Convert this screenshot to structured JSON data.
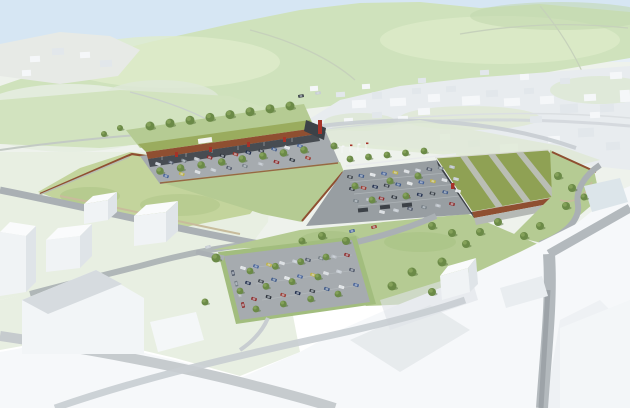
{
  "colors": {
    "sky_top": "#d6e6f3",
    "sky_mid": "#e7eff6",
    "base_pale": "#eef2ec",
    "hill_green": "#cfe2bc",
    "hill_light": "#deecca",
    "hill_dark": "#c1d7ad",
    "mint": "#e8efe2",
    "town_base": "#e8ecef",
    "town_block": "#f5f7f9",
    "town_block_shade": "#e2e7eb",
    "town_shadow": "#cfd5da",
    "meadow": "#c3d49c",
    "slope_green": "#b5cb93",
    "slope_dark": "#a2bd7e",
    "roof_green": "#8fa154",
    "roof_light": "#9aac5e",
    "roof_stripe": "#babeb4",
    "corten": "#8f4f31",
    "wall_grey": "#b7bcb3",
    "asphalt": "#a6abaf",
    "asphalt_dark": "#989ea2",
    "road_grey": "#aab0b4",
    "road_light": "#c8cdd1",
    "path_tan": "#c8bc9c",
    "storefront": "#474c52",
    "dark_unit": "#3c4147",
    "accent_red": "#a63228",
    "fence": "#e9ebec",
    "white_roof": "#fafbfc",
    "white_front": "#f0f3f5",
    "white_side": "#dfe4e8",
    "fg_white": "#f6f8fa",
    "fg_shadow": "#e3e7ea",
    "glass": "#dce5ea",
    "tree": "#6b8a47",
    "tree_light": "#84a159",
    "tree_dark": "#4e6a33"
  },
  "car_palette": [
    "#c7ccd2",
    "#2f353d",
    "#e8eaeb",
    "#51596a",
    "#9d3a31",
    "#47639a",
    "#778087",
    "#23304e",
    "#c0b344",
    "#b9bec4",
    "#3b4148",
    "#dfe1e3",
    "#8f2c2c",
    "#405a88"
  ],
  "car_rows": [
    {
      "x1": 158,
      "y1": 164,
      "x2": 300,
      "y2": 146,
      "n": 12,
      "rot": 20
    },
    {
      "x1": 166,
      "y1": 176,
      "x2": 308,
      "y2": 158,
      "n": 10,
      "rot": 20
    },
    {
      "x1": 350,
      "y1": 177,
      "x2": 452,
      "y2": 167,
      "n": 10,
      "rot": 15
    },
    {
      "x1": 352,
      "y1": 189,
      "x2": 456,
      "y2": 179,
      "n": 10,
      "rot": 15
    },
    {
      "x1": 356,
      "y1": 201,
      "x2": 458,
      "y2": 191,
      "n": 9,
      "rot": 15
    },
    {
      "x1": 382,
      "y1": 212,
      "x2": 452,
      "y2": 204,
      "n": 6,
      "rot": 15
    },
    {
      "x1": 243,
      "y1": 268,
      "x2": 347,
      "y2": 255,
      "n": 9,
      "rot": 18
    },
    {
      "x1": 248,
      "y1": 283,
      "x2": 352,
      "y2": 270,
      "n": 9,
      "rot": 18
    },
    {
      "x1": 254,
      "y1": 299,
      "x2": 356,
      "y2": 285,
      "n": 8,
      "rot": 18
    },
    {
      "x1": 233,
      "y1": 273,
      "x2": 243,
      "y2": 305,
      "n": 4,
      "rot": 75
    }
  ],
  "cars_single": [
    {
      "x": 352,
      "y": 231,
      "rot": -14,
      "color": "#47639a"
    },
    {
      "x": 208,
      "y": 247,
      "rot": -16,
      "color": "#c7ccd2"
    },
    {
      "x": 374,
      "y": 227,
      "rot": -14,
      "color": "#9d3a31"
    },
    {
      "x": 301,
      "y": 96,
      "rot": -8,
      "color": "#2f353d"
    },
    {
      "x": 318,
      "y": 93,
      "rot": -8,
      "color": "#c7ccd2"
    }
  ],
  "tree_lines": [
    {
      "x1": 150,
      "y1": 126,
      "x2": 290,
      "y2": 106,
      "n": 8,
      "r": 4.5
    },
    {
      "x1": 160,
      "y1": 171,
      "x2": 304,
      "y2": 150,
      "n": 8,
      "r": 3.8
    },
    {
      "x1": 350,
      "y1": 159,
      "x2": 424,
      "y2": 151,
      "n": 5,
      "r": 3.4
    },
    {
      "x1": 250,
      "y1": 271,
      "x2": 326,
      "y2": 257,
      "n": 4,
      "r": 3.4
    },
    {
      "x1": 240,
      "y1": 291,
      "x2": 318,
      "y2": 277,
      "n": 4,
      "r": 3.4
    },
    {
      "x1": 256,
      "y1": 309,
      "x2": 338,
      "y2": 294,
      "n": 4,
      "r": 3.4
    }
  ],
  "trees_single": [
    [
      355,
      186,
      3.5
    ],
    [
      390,
      181,
      3.5
    ],
    [
      418,
      176,
      3.5
    ],
    [
      372,
      200,
      3.5
    ],
    [
      406,
      196,
      3.5
    ],
    [
      334,
      146,
      3.5
    ],
    [
      558,
      176,
      4
    ],
    [
      572,
      188,
      4
    ],
    [
      566,
      206,
      4
    ],
    [
      584,
      197,
      3.5
    ],
    [
      540,
      226,
      4
    ],
    [
      524,
      236,
      4
    ],
    [
      322,
      236,
      4
    ],
    [
      346,
      241,
      4
    ],
    [
      302,
      241,
      3.5
    ],
    [
      432,
      226,
      4
    ],
    [
      452,
      233,
      4
    ],
    [
      466,
      244,
      4
    ],
    [
      442,
      262,
      4.5
    ],
    [
      412,
      272,
      4.5
    ],
    [
      392,
      286,
      4.5
    ],
    [
      432,
      292,
      4
    ],
    [
      216,
      258,
      4.5
    ],
    [
      205,
      302,
      3.5
    ],
    [
      120,
      128,
      3
    ],
    [
      104,
      134,
      3
    ],
    [
      498,
      222,
      4
    ],
    [
      480,
      232,
      4
    ]
  ],
  "shelters": [
    [
      363,
      210
    ],
    [
      385,
      207
    ],
    [
      407,
      205
    ]
  ],
  "flag_poles": [
    [
      342,
      153
    ],
    [
      350,
      152
    ],
    [
      358,
      151
    ],
    [
      366,
      150
    ]
  ],
  "town_blocks": [
    [
      352,
      100,
      14,
      8,
      0
    ],
    [
      372,
      92,
      10,
      7,
      1
    ],
    [
      390,
      98,
      16,
      8,
      0
    ],
    [
      412,
      88,
      9,
      6,
      1
    ],
    [
      428,
      94,
      12,
      8,
      0
    ],
    [
      446,
      86,
      10,
      6,
      1
    ],
    [
      462,
      96,
      18,
      9,
      0
    ],
    [
      486,
      90,
      12,
      7,
      1
    ],
    [
      504,
      98,
      16,
      8,
      0
    ],
    [
      524,
      88,
      10,
      6,
      1
    ],
    [
      540,
      96,
      14,
      8,
      0
    ],
    [
      560,
      104,
      18,
      9,
      1
    ],
    [
      584,
      94,
      12,
      7,
      0
    ],
    [
      600,
      104,
      14,
      8,
      1
    ],
    [
      418,
      108,
      12,
      7,
      0
    ],
    [
      372,
      112,
      10,
      6,
      1
    ],
    [
      344,
      118,
      9,
      5,
      0
    ],
    [
      578,
      128,
      16,
      9,
      1
    ],
    [
      548,
      136,
      12,
      7,
      0
    ],
    [
      606,
      142,
      14,
      8,
      1
    ],
    [
      500,
      144,
      18,
      9,
      0
    ],
    [
      468,
      140,
      12,
      7,
      1
    ],
    [
      440,
      134,
      10,
      6,
      0
    ],
    [
      610,
      72,
      12,
      7,
      0
    ],
    [
      560,
      78,
      10,
      6,
      1
    ],
    [
      520,
      74,
      9,
      6,
      0
    ],
    [
      480,
      70,
      9,
      5,
      1
    ],
    [
      590,
      112,
      10,
      6,
      0
    ],
    [
      530,
      116,
      12,
      7,
      1
    ],
    [
      398,
      116,
      10,
      6,
      0
    ],
    [
      620,
      90,
      10,
      12,
      0
    ],
    [
      30,
      56,
      10,
      6,
      0
    ],
    [
      52,
      48,
      12,
      7,
      1
    ],
    [
      80,
      52,
      10,
      6,
      0
    ],
    [
      100,
      60,
      12,
      7,
      1
    ],
    [
      22,
      70,
      9,
      6,
      0
    ],
    [
      310,
      86,
      8,
      5,
      0
    ],
    [
      336,
      92,
      9,
      5,
      1
    ],
    [
      362,
      84,
      8,
      5,
      0
    ],
    [
      418,
      78,
      8,
      5,
      1
    ]
  ]
}
